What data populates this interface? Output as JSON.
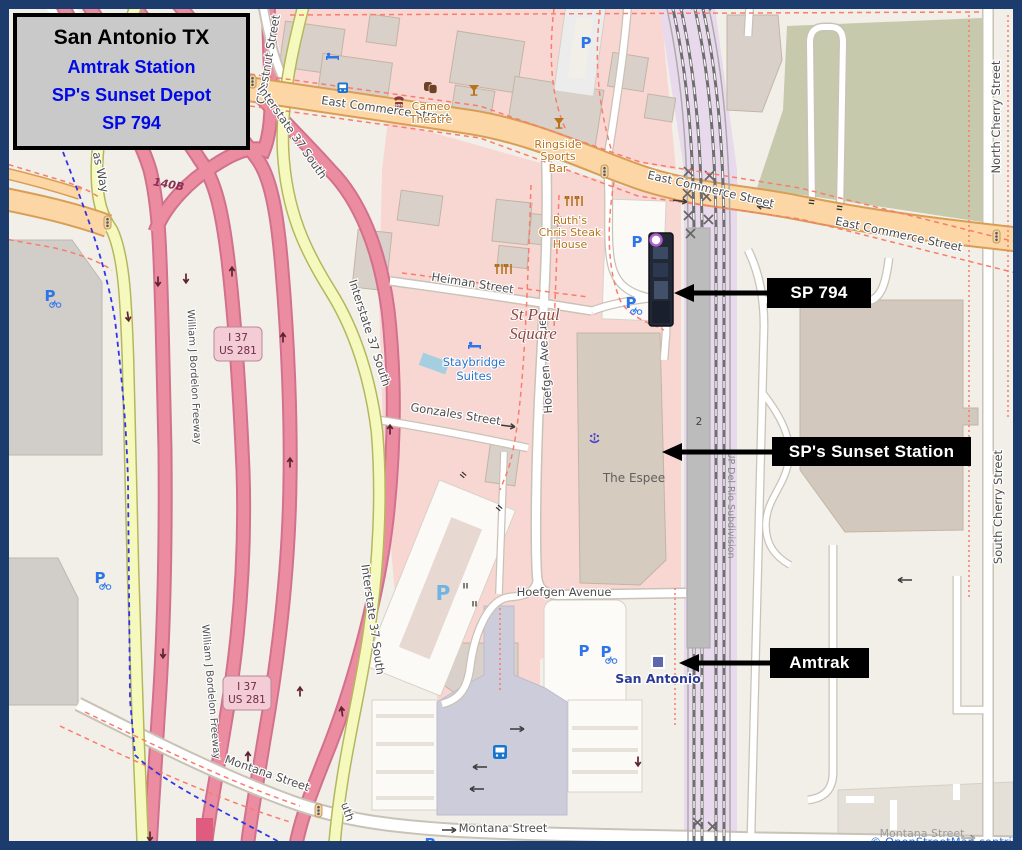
{
  "title_card": {
    "title": "San Antonio TX",
    "lines": [
      "Amtrak Station",
      "SP's Sunset Depot",
      "SP 794"
    ]
  },
  "callouts": {
    "sp794": "SP 794",
    "sunset": "SP's Sunset Station",
    "amtrak": "Amtrak"
  },
  "roads": {
    "east_commerce": "East Commerce Street",
    "chestnut": "Chestnut Street",
    "heiman": "Heiman Street",
    "hoefgen": "Hoefgen Avenue",
    "gonzales": "Gonzales Street",
    "montana": "Montana Street",
    "north_cherry": "North Cherry Street",
    "south_cherry": "South Cherry Street",
    "interstate": "Interstate 37 South",
    "interstate_partial": "uth",
    "bordelon": "William J Bordelon Freeway",
    "as_way": "as Way",
    "exit": "140B",
    "shield_line1": "I 37",
    "shield_line2": "US 281",
    "subdivision": "UP Del Rio Subdivision",
    "track_number": "2"
  },
  "places": {
    "st_paul_1": "St Paul",
    "st_paul_2": "Square",
    "espee": "The Espee",
    "staybridge_1": "Staybridge",
    "staybridge_2": "Suites",
    "ruths_1": "Ruth's",
    "ruths_2": "Chris Steak",
    "ruths_3": "House",
    "ringside_1": "Ringside",
    "ringside_2": "Sports",
    "ringside_3": "Bar",
    "cameo_1": "Cameo",
    "cameo_2": "Theatre",
    "san_antonio": "San Antonio",
    "sos": "sos"
  },
  "icons": {
    "parking": "P"
  },
  "attribution": "© OpenStreetMap contrib",
  "colors": {
    "map_bg": "#f2efe8",
    "retail_pink": "#f8d7d3",
    "rail_lavender": "#e9d9ec",
    "green_area": "#c7c9ac",
    "building": "#d9d0c9",
    "station_brown": "#b7a99b",
    "primary_road": "#fcd6a4",
    "secondary_road": "#f6f9bd",
    "motorway": "#ec8ca1",
    "plaza": "#cdccdb",
    "callout_bg": "#000000",
    "title_blue": "#0009e6",
    "border_navy": "#1c3c6e",
    "red_dash": "#fa7c6c",
    "cycle_blue": "#3333e8",
    "parking_blue": "#2e75e9",
    "attrib_blue": "#2f6fd0"
  }
}
